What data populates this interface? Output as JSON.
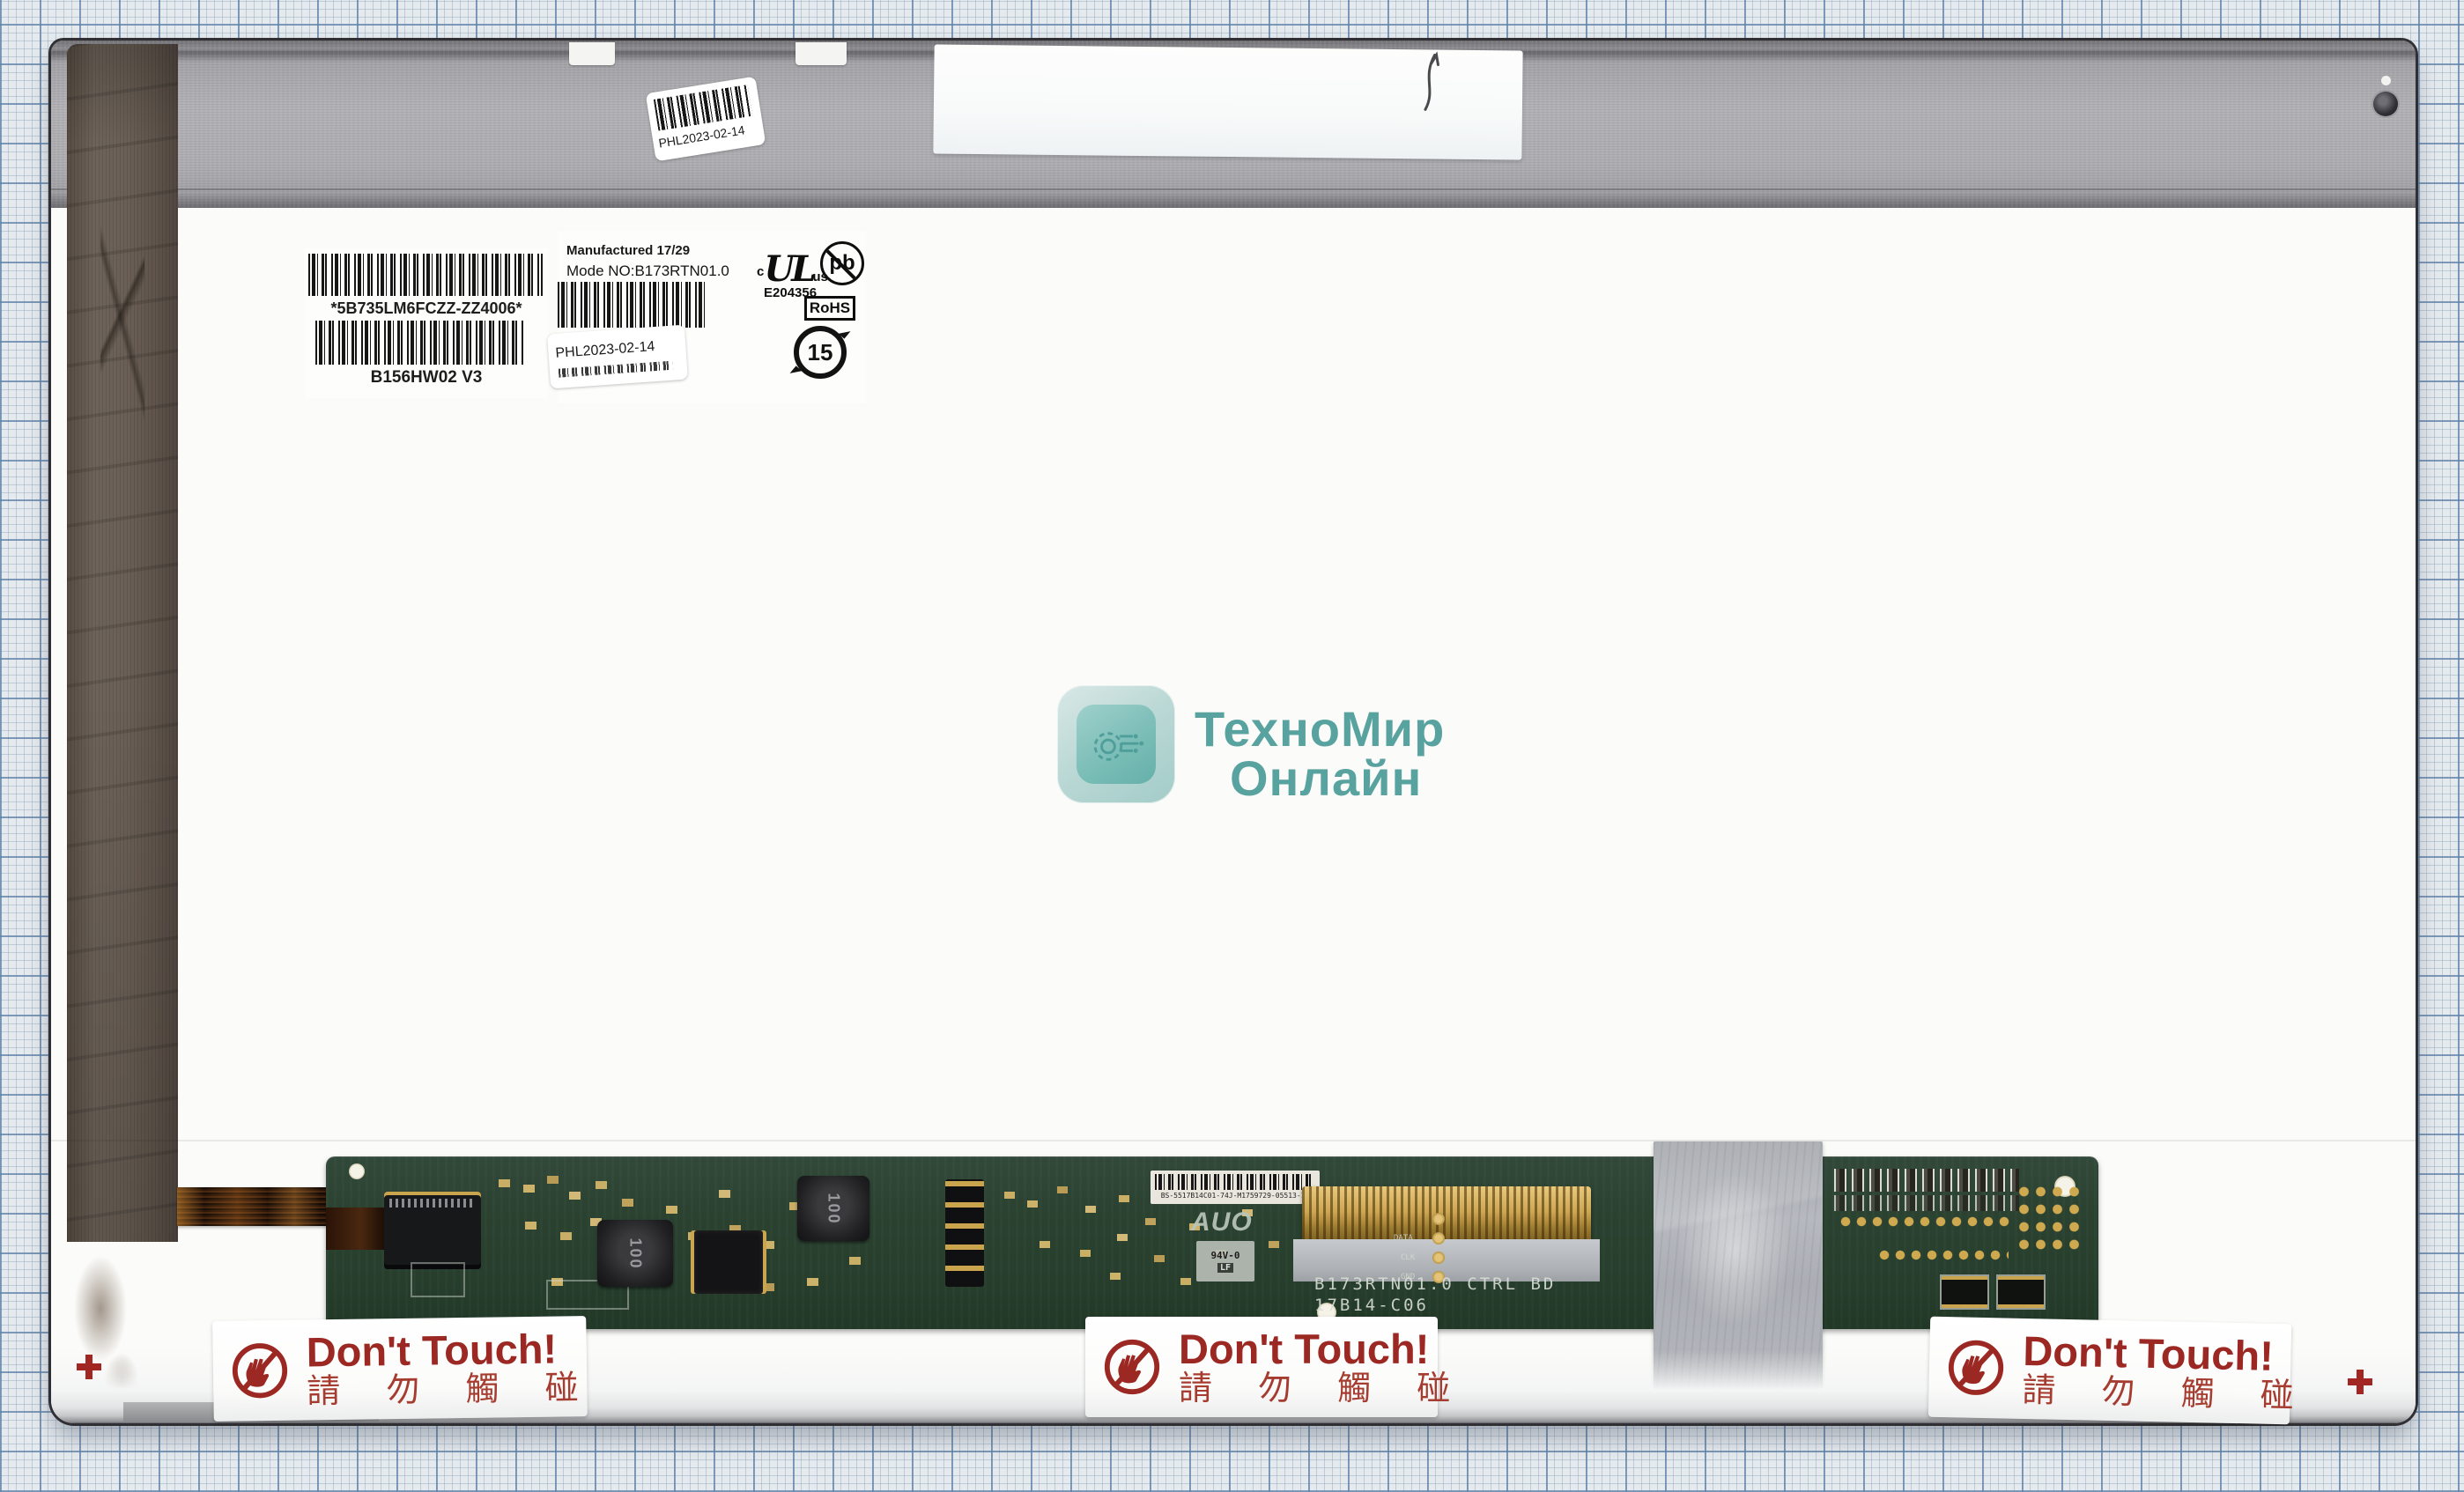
{
  "scene": {
    "description": "LCD laptop screen panel rear view lying on blue millimeter graph paper",
    "colors": {
      "grid_minor": "#96acc0",
      "grid_major": "#5f82a8",
      "panel_white": "#fbfbf9",
      "metal_strip": "#aaaaae",
      "tape_brown": "#645a50",
      "pcb_green": "#2b4231",
      "warning_red": "#9c2823",
      "brand_teal": "#58a39f"
    },
    "icons": {
      "no_touch": "crossed-out-hand-icon",
      "lead_free": "pb-crossed-circle-icon",
      "ul_certification": "cULus-mark",
      "china_rohs": "recycle-15-circle-icon",
      "brand_logo": "gear-circuit-icon",
      "screw": "screw-head"
    }
  },
  "serial_label": {
    "barcode_text": "*5B735LM6FCZZ-ZZ4006*",
    "model_text": "B156HW02 V3"
  },
  "mfg_label": {
    "manufactured": "Manufactured 17/29",
    "model_no": "Mode NO:B173RTN01.0",
    "ul_prefix": "c",
    "ul": "UL",
    "ul_suffix": "us",
    "ul_file": "E204356",
    "pb": "pb",
    "rohs": "RoHS",
    "recycle_years": "15"
  },
  "date_sticker": {
    "text": "PHL2023-02-14"
  },
  "watermark": {
    "brand_line1": "ТехноМир",
    "brand_line2": "Онлайн"
  },
  "pcb": {
    "barcode_label_text": "BS-5517B14C01-74J-M1759729-05513-11",
    "brand": "AUO",
    "flammability": "94V-0",
    "lead_free": "LF",
    "silk_line1": "B173RTN01.0 CTRL BD",
    "silk_line2": "17B14-C06",
    "inductor_value": "100",
    "testpoints": [
      "DATA",
      "CLK",
      "GND"
    ]
  },
  "warning": {
    "title": "Don't Touch!",
    "subtitle": "請 勿 觸 碰"
  }
}
